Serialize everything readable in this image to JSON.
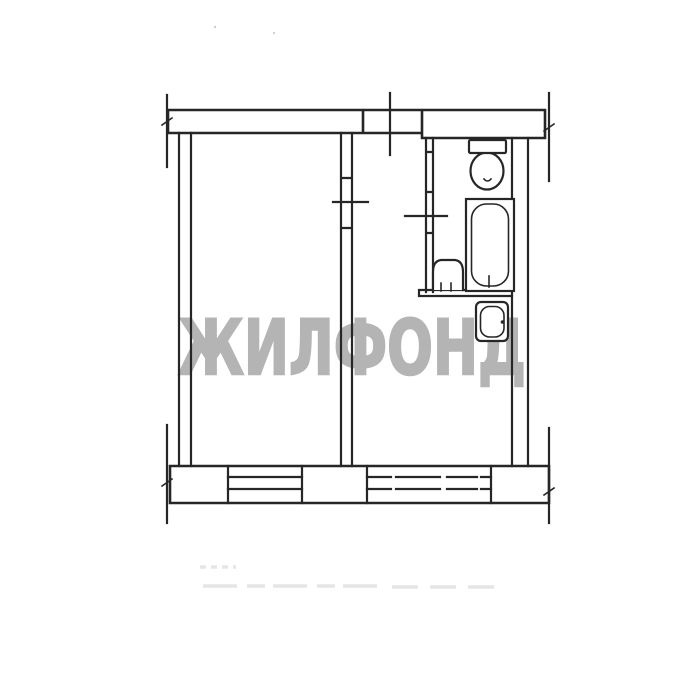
{
  "page": {
    "background": "#ffffff"
  },
  "watermark": {
    "text": "ЖИЛФОНД",
    "color": "#b4b4b4"
  },
  "plan": {
    "line_color": "#262626",
    "artifact_color": "#dedede",
    "window_count": 2,
    "fixture_icons": [
      "toilet-icon",
      "bathtub-icon",
      "washbasin-icon",
      "kitchen-sink-icon"
    ]
  }
}
